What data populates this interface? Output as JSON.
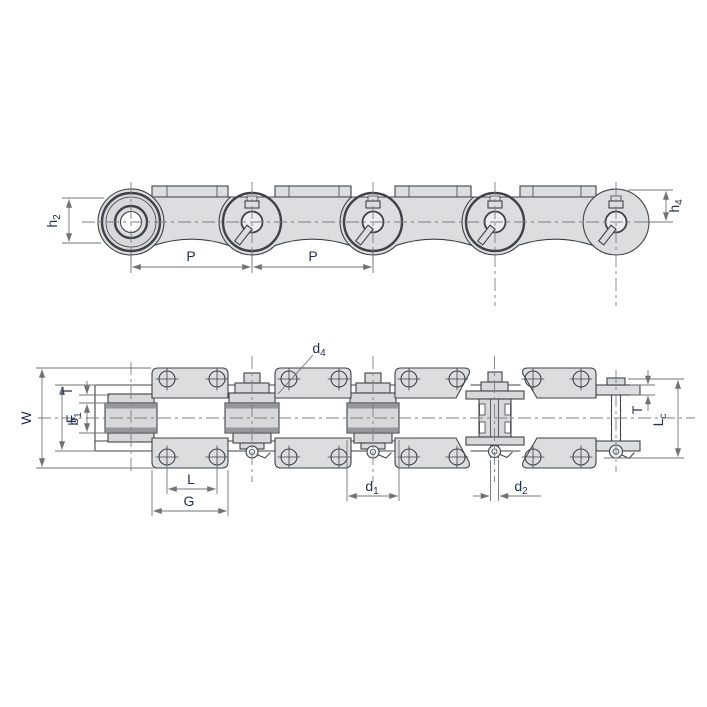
{
  "drawing": {
    "colors": {
      "background": "#ffffff",
      "body_fill": "#dbdddf",
      "outline": "#3f4347",
      "dimension_lines": "#6f7377",
      "label_text": "#223055"
    },
    "top_view": {
      "labels": {
        "h2": {
          "base": "h",
          "sub": "2"
        },
        "p1": {
          "base": "P",
          "sub": ""
        },
        "p2": {
          "base": "P",
          "sub": ""
        },
        "h4": {
          "base": "h",
          "sub": "4"
        }
      }
    },
    "bottom_view": {
      "labels": {
        "W": {
          "base": "W",
          "sub": ""
        },
        "F": {
          "base": "F",
          "sub": ""
        },
        "T_left": {
          "base": "T",
          "sub": ""
        },
        "b1": {
          "base": "b",
          "sub": "1"
        },
        "d4": {
          "base": "d",
          "sub": "4"
        },
        "L": {
          "base": "L",
          "sub": ""
        },
        "G": {
          "base": "G",
          "sub": ""
        },
        "d1": {
          "base": "d",
          "sub": "1"
        },
        "d2": {
          "base": "d",
          "sub": "2"
        },
        "T_right": {
          "base": "T",
          "sub": ""
        },
        "Lc": {
          "base": "L",
          "sub": "c"
        }
      }
    }
  }
}
